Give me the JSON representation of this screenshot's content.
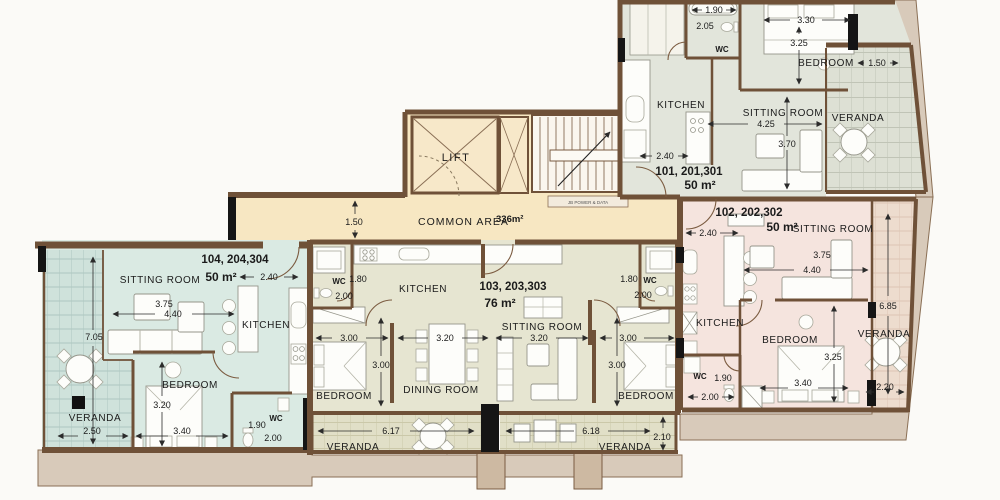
{
  "plan_colors": {
    "common_area": "#F7E7C2",
    "unit_101": "#E2E5DB",
    "unit_102": "#F5E4DE",
    "unit_103": "#E6E5D1",
    "unit_104": "#DAEAE3",
    "veranda_101": "#DDE0D4",
    "veranda_102": "#EDDCCE",
    "veranda_103": "#E1DFC7",
    "veranda_104": "#CFE2DB",
    "wall_brown": "#6F5138",
    "exterior_band": "#D8CABA",
    "stair_fill": "#FAF6EE"
  },
  "common": {
    "lift_label": "LIFT",
    "area_label": "COMMON AREA",
    "area_value": "336m²",
    "junction_label": "JB POWER & DATA",
    "dim_width": "1.50"
  },
  "unit_101": {
    "name": "101, 201,301",
    "size": "50 m²",
    "rooms": {
      "kitchen": "KITCHEN",
      "sitting": "SITTING ROOM",
      "bedroom": "BEDROOM",
      "veranda": "VERANDA",
      "wc": "WC"
    },
    "dims": {
      "bath": "1.90",
      "wc_depth": "2.05",
      "bed_w": "3.30",
      "bed_h": "3.25",
      "veranda_w": "1.50",
      "sitting_w": "4.25",
      "sitting_h": "3.70",
      "kitchen_w": "2.40"
    }
  },
  "unit_102": {
    "name": "102, 202,302",
    "size": "50 m²",
    "rooms": {
      "kitchen": "KITCHEN",
      "sitting": "SITTING ROOM",
      "bedroom": "BEDROOM",
      "veranda": "VERANDA",
      "wc": "WC"
    },
    "dims": {
      "kitchen_w": "2.40",
      "sitting_w1": "3.75",
      "sitting_w2": "4.40",
      "bed_h": "3.25",
      "bed_w": "3.40",
      "veranda_h": "6.85",
      "veranda_w": "2.20",
      "wc_w": "1.90",
      "wc_d": "2.00"
    }
  },
  "unit_103": {
    "name": "103, 203,303",
    "size": "76 m²",
    "rooms": {
      "kitchen": "KITCHEN",
      "sitting": "SITTING ROOM",
      "dining": "DINING ROOM",
      "bedroom_left": "BEDROOM",
      "bedroom_right": "BEDROOM",
      "veranda_left": "VERANDA",
      "veranda_right": "VERANDA",
      "wc_left": "WC",
      "wc_right": "WC"
    },
    "dims": {
      "wc_left_w": "1.80",
      "wc_left_d": "2.00",
      "wc_right_w": "1.80",
      "wc_right_d": "2.00",
      "bed_left_w": "3.00",
      "dining_w": "3.20",
      "sitting_w": "3.20",
      "bed_right_w": "3.00",
      "bed_left_h": "3.00",
      "bed_right_h": "3.00",
      "veranda_left_w": "6.17",
      "veranda_right_w": "6.18",
      "veranda_h": "2.10"
    }
  },
  "unit_104": {
    "name": "104, 204,304",
    "size": "50 m²",
    "rooms": {
      "kitchen": "KITCHEN",
      "sitting": "SITTING ROOM",
      "bedroom": "BEDROOM",
      "veranda": "VERANDA",
      "wc": "WC"
    },
    "dims": {
      "kitchen_w": "2.40",
      "sitting_w1": "3.75",
      "sitting_w2": "4.40",
      "veranda_h": "7.05",
      "bed_h": "3.20",
      "bed_w": "3.40",
      "veranda_w": "2.50",
      "wc_w": "1.90",
      "wc_d": "2.00"
    }
  }
}
